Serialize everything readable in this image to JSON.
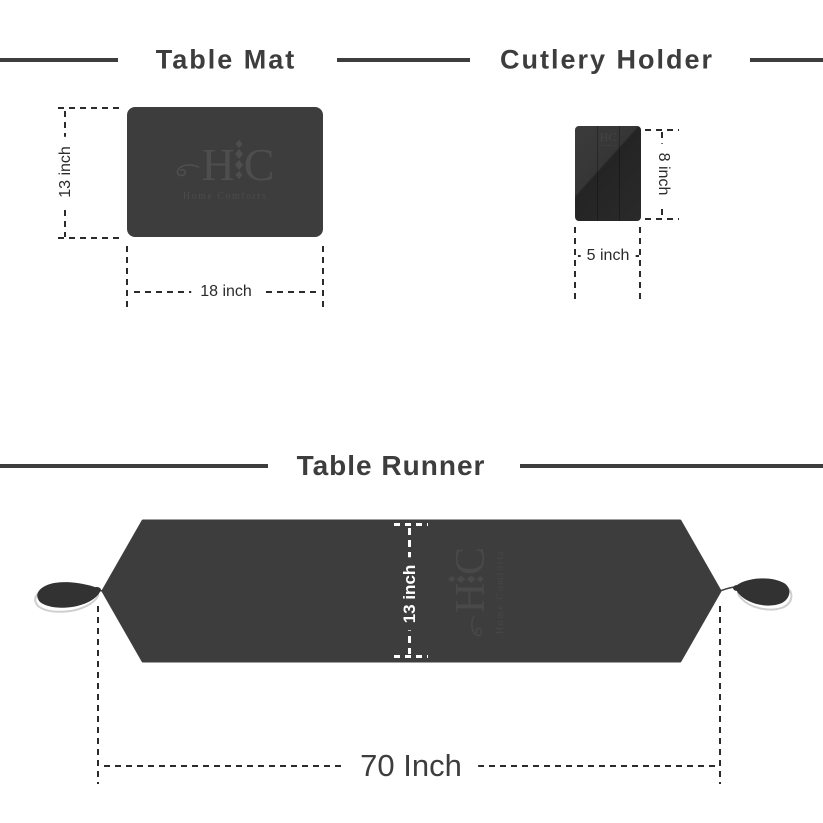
{
  "brand": {
    "monogram": "HC",
    "monogram_left": "H",
    "monogram_right": "C",
    "name": "Home Comforts"
  },
  "table_mat": {
    "title": "Table Mat",
    "height_label": "13 inch",
    "width_label": "18 inch"
  },
  "cutlery_holder": {
    "title": "Cutlery Holder",
    "height_label": "8 inch",
    "width_label": "5 inch"
  },
  "table_runner": {
    "title": "Table Runner",
    "height_label": "13 inch",
    "width_label": "70 Inch"
  },
  "colors": {
    "background": "#ffffff",
    "fabric": "#3d3d3d",
    "holder_dark": "#2b2b2b",
    "title_text": "#3d3d3d",
    "dimension_line": "#2b2b2b",
    "runner_dimension": "#ffffff",
    "watermark": "#4e4e4e"
  }
}
